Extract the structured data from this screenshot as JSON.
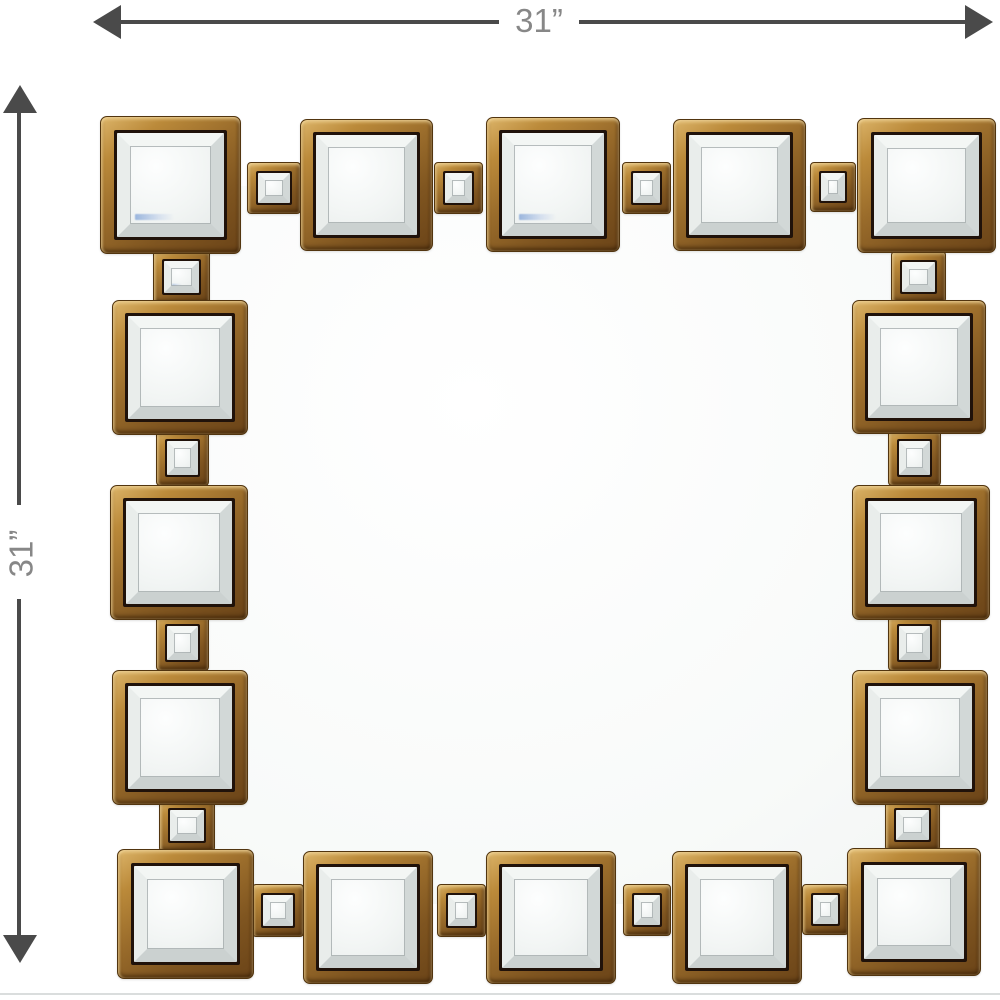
{
  "dimensions": {
    "width_label": "31”",
    "height_label": "31”"
  },
  "icons": {
    "width_arrow": "double-headed-horizontal-arrow-icon",
    "height_arrow": "double-headed-vertical-arrow-icon"
  },
  "palette": {
    "gold_light": "#dcb469",
    "gold": "#a87b33",
    "gold_dark": "#6b4418",
    "frame_outline": "#52350f",
    "frame_inner_line": "#20120a",
    "bevel_light": "#f3f6f4",
    "bevel_shade": "#cbd1d0",
    "mirror_glass": "#eef1f0",
    "dimension_line": "#4a4a4a",
    "dimension_text": "#878787"
  }
}
